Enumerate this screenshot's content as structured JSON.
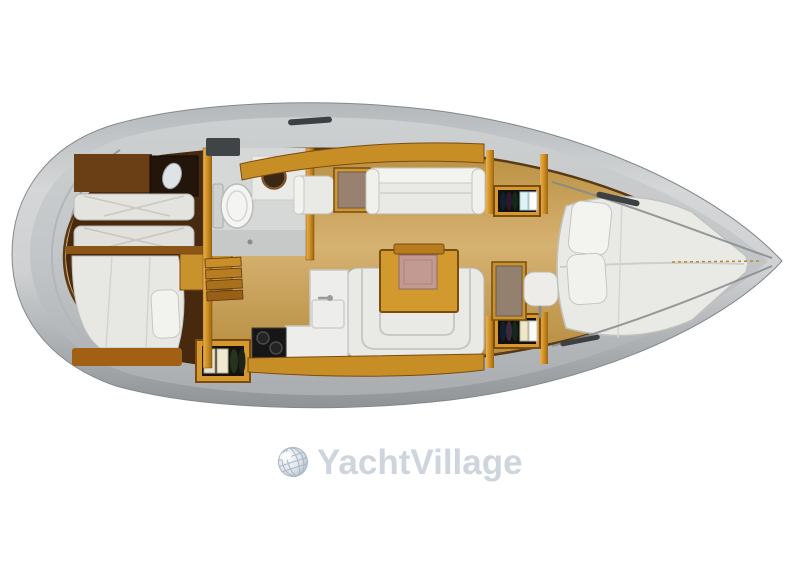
{
  "watermark": {
    "label": "YachtVillage",
    "icon": "globe-icon",
    "color": "#cfd5dd"
  },
  "palette": {
    "background": "#ffffff",
    "hull_gray": "#a9adb0",
    "deck_gray": "#c6c9cb",
    "wood_floor": "#cda761",
    "cabinet_orange": "#d6992f",
    "dark_wood": "#46290e",
    "upholstery_white": "#e9e9e5",
    "table_accent_pink": "#c29a91",
    "stove_black": "#161616",
    "watermark_gray": "#cfd5dd"
  },
  "floorplan": {
    "type": "sailing-yacht-interior-top-view",
    "areas": [
      "aft-port-cabin-twin-berths",
      "aft-starboard-cabin-double-berth",
      "head-with-toilet-and-sink",
      "companionway-steps",
      "chart-table-and-seat",
      "salon-long-settee",
      "u-shaped-settee-with-table",
      "galley-stove-sink-counter",
      "storage-lockers-with-bottles",
      "forward-cabin-vanity-and-stool",
      "forward-v-berth"
    ]
  }
}
